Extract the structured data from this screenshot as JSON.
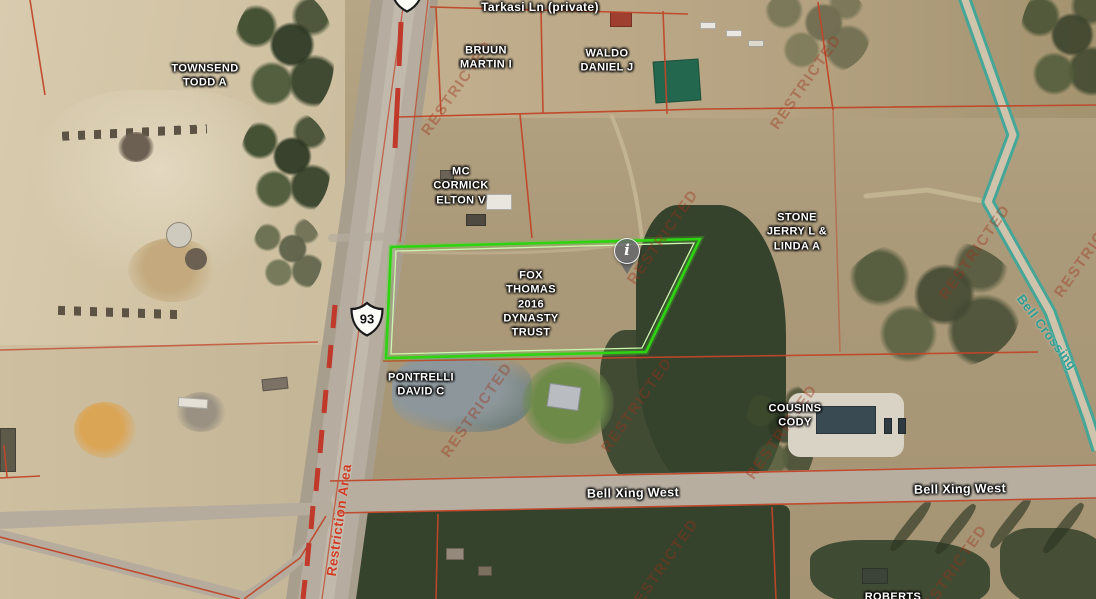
{
  "map": {
    "watermark_text": "RESTRICTED",
    "colors": {
      "parcel_line": "#c0472a",
      "highlight_outline": "#2ed312",
      "highlight_inner": "#cdf7b0",
      "teal_road": "#3aa79b",
      "restriction_text": "#cf3b23",
      "watermark": "rgba(158,48,26,0.40)",
      "label_text": "#ffffff"
    },
    "highway": {
      "shield_number": "93"
    },
    "marker": {
      "glyph": "i"
    },
    "parcel_labels": [
      {
        "id": "townsend",
        "name": "TOWNSEND\nTODD A"
      },
      {
        "id": "bruun",
        "name": "BRUUN\nMARTIN I"
      },
      {
        "id": "waldo",
        "name": "WALDO\nDANIEL J"
      },
      {
        "id": "mccormick",
        "name": "MC\nCORMICK\nELTON V"
      },
      {
        "id": "stone",
        "name": "STONE\nJERRY L &\nLINDA A"
      },
      {
        "id": "fox",
        "name": "FOX\nTHOMAS\n2016\nDYNASTY\nTRUST",
        "highlighted": true
      },
      {
        "id": "pontrelli",
        "name": "PONTRELLI\nDAVID C"
      },
      {
        "id": "cousins",
        "name": "COUSINS\nCODY"
      },
      {
        "id": "roberts",
        "name": "ROBERTS"
      }
    ],
    "road_labels": [
      {
        "id": "tarkasi",
        "text": "Tarkasi Ln (private)"
      },
      {
        "id": "bell-xing-west-1",
        "text": "Bell Xing West"
      },
      {
        "id": "bell-xing-west-2",
        "text": "Bell Xing West"
      },
      {
        "id": "bell-crossing",
        "text": "Bell Crossing"
      },
      {
        "id": "restriction-area",
        "text": "Restriction Area"
      }
    ]
  }
}
